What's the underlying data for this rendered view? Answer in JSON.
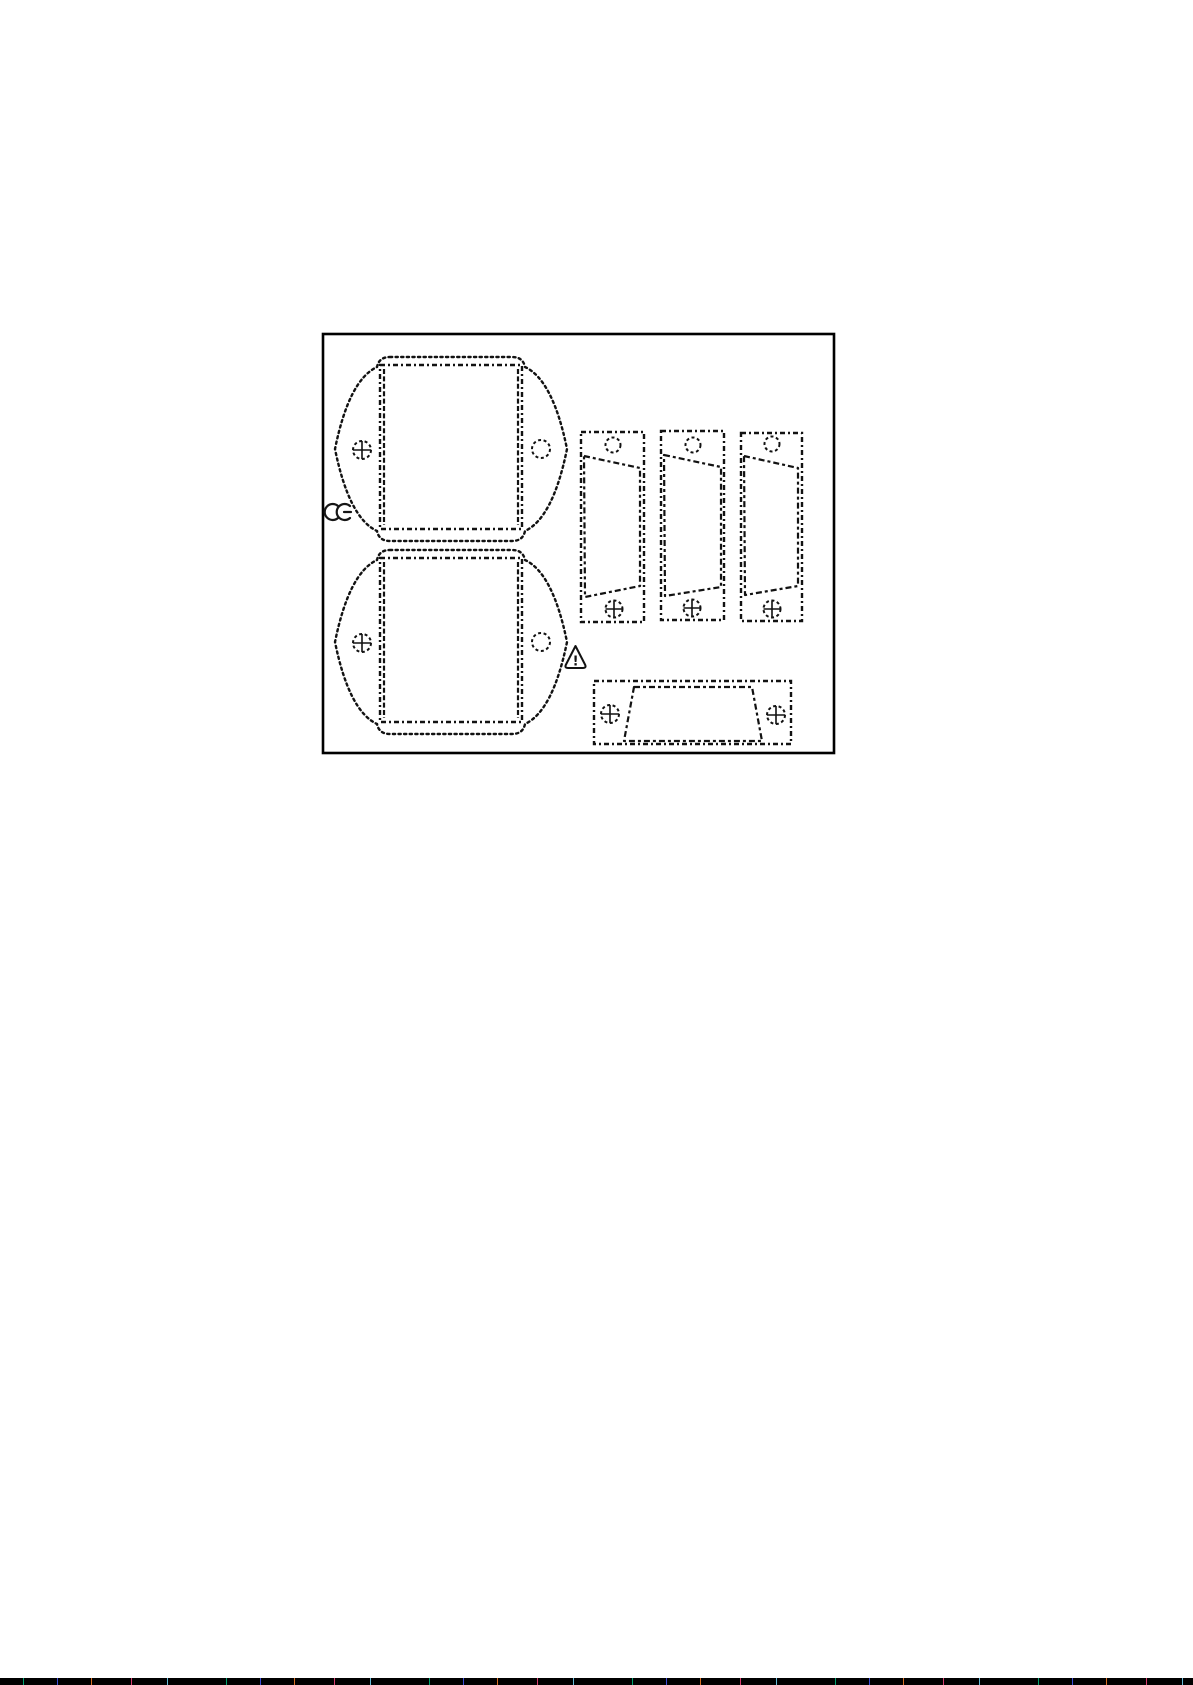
{
  "document": {
    "type": "scanned-instruction-sheet-figure",
    "background": "#ffffff",
    "ink": "#121212",
    "frame_color": "#000000",
    "figure": {
      "parts": [
        {
          "name": "large gasket template top",
          "holes": [
            "crosshead-screw",
            "round-hole"
          ]
        },
        {
          "name": "large gasket template bottom",
          "holes": [
            "crosshead-screw",
            "round-hole"
          ]
        },
        {
          "name": "vertical strip template 1",
          "holes": [
            "round-hole",
            "crosshead-screw"
          ]
        },
        {
          "name": "vertical strip template 2",
          "holes": [
            "round-hole",
            "crosshead-screw"
          ]
        },
        {
          "name": "vertical strip template 3",
          "holes": [
            "round-hole",
            "crosshead-screw"
          ]
        },
        {
          "name": "horizontal strip template",
          "holes": [
            "crosshead-screw",
            "crosshead-screw"
          ]
        }
      ],
      "icons": {
        "ce_mark": "CE",
        "warning_triangle": "!"
      }
    },
    "artifacts": {
      "bottom_scan_line": "black noise scanline"
    }
  }
}
